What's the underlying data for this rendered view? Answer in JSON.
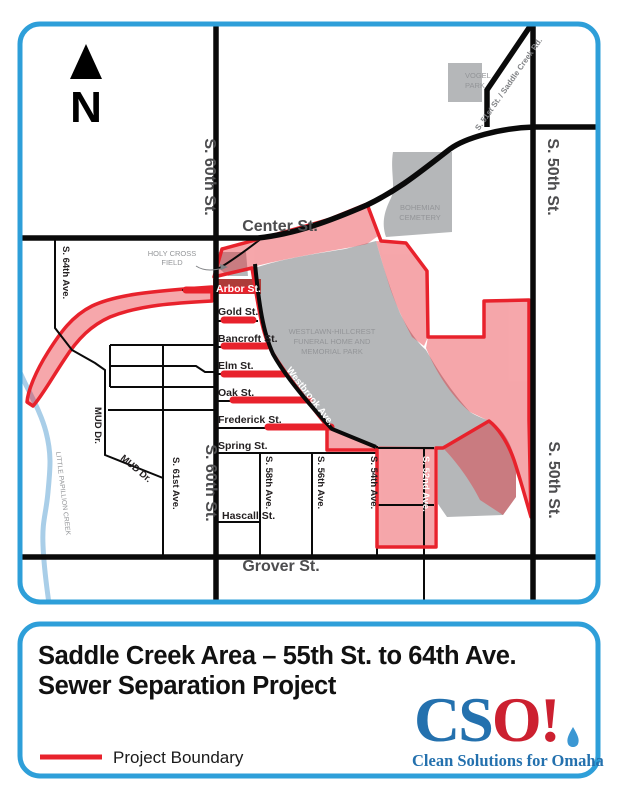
{
  "colors": {
    "frame_blue": "#2E9FD9",
    "boundary_red": "#E8222C",
    "arbor_bg_red": "#AD3C39",
    "area_gray": "#B5B7B9",
    "road_black": "#0A0A0A",
    "creek_blue": "#A9CEE8",
    "label_gray": "#939598",
    "street_label_dark": "#4D4D4F",
    "minor_label_dark": "#231F20",
    "logo_blue": "#2471AE",
    "logo_red": "#CC2030",
    "drop_blue": "#3B97D3",
    "title_black": "#111111"
  },
  "map": {
    "north": "N",
    "labels": {
      "center_st": "Center St.",
      "grover_st": "Grover St.",
      "s60": "S. 60th St.",
      "s50": "S. 50th St.",
      "s64": "S. 64th Ave.",
      "s61": "S. 61st Ave.",
      "s58": "S. 58th Ave.",
      "s56": "S. 56th Ave.",
      "s54": "S. 54th Ave.",
      "s52": "S. 52nd Ave.",
      "mud": "MUD Dr.",
      "saddle": "S. 51st St. / Saddle Creek Rd.",
      "westbrook": "Westbrook Ave.",
      "arbor": "Arbor St.",
      "gold": "Gold St.",
      "bancroft": "Bancroft St.",
      "elm": "Elm St.",
      "oak": "Oak St.",
      "frederick": "Frederick St.",
      "spring": "Spring St.",
      "hascall": "Hascall St."
    },
    "areas": {
      "holy_cross_1": "HOLY CROSS",
      "holy_cross_2": "FIELD",
      "vogel_1": "VOGEL",
      "vogel_2": "PARK",
      "bohemian_1": "BOHEMIAN",
      "bohemian_2": "CEMETERY",
      "westlawn_1": "WESTLAWN-HILLCREST",
      "westlawn_2": "FUNERAL HOME AND",
      "westlawn_3": "MEMORIAL PARK",
      "creek": "LITTLE PAPILLION CREEK"
    }
  },
  "footer": {
    "title_line1": "Saddle Creek Area – 55th St. to 64th Ave.",
    "title_line2": "Sewer Separation Project",
    "legend_label": "Project Boundary",
    "logo_cs": "CS",
    "logo_o": "O!",
    "logo_tagline": "Clean Solutions for Omaha"
  }
}
